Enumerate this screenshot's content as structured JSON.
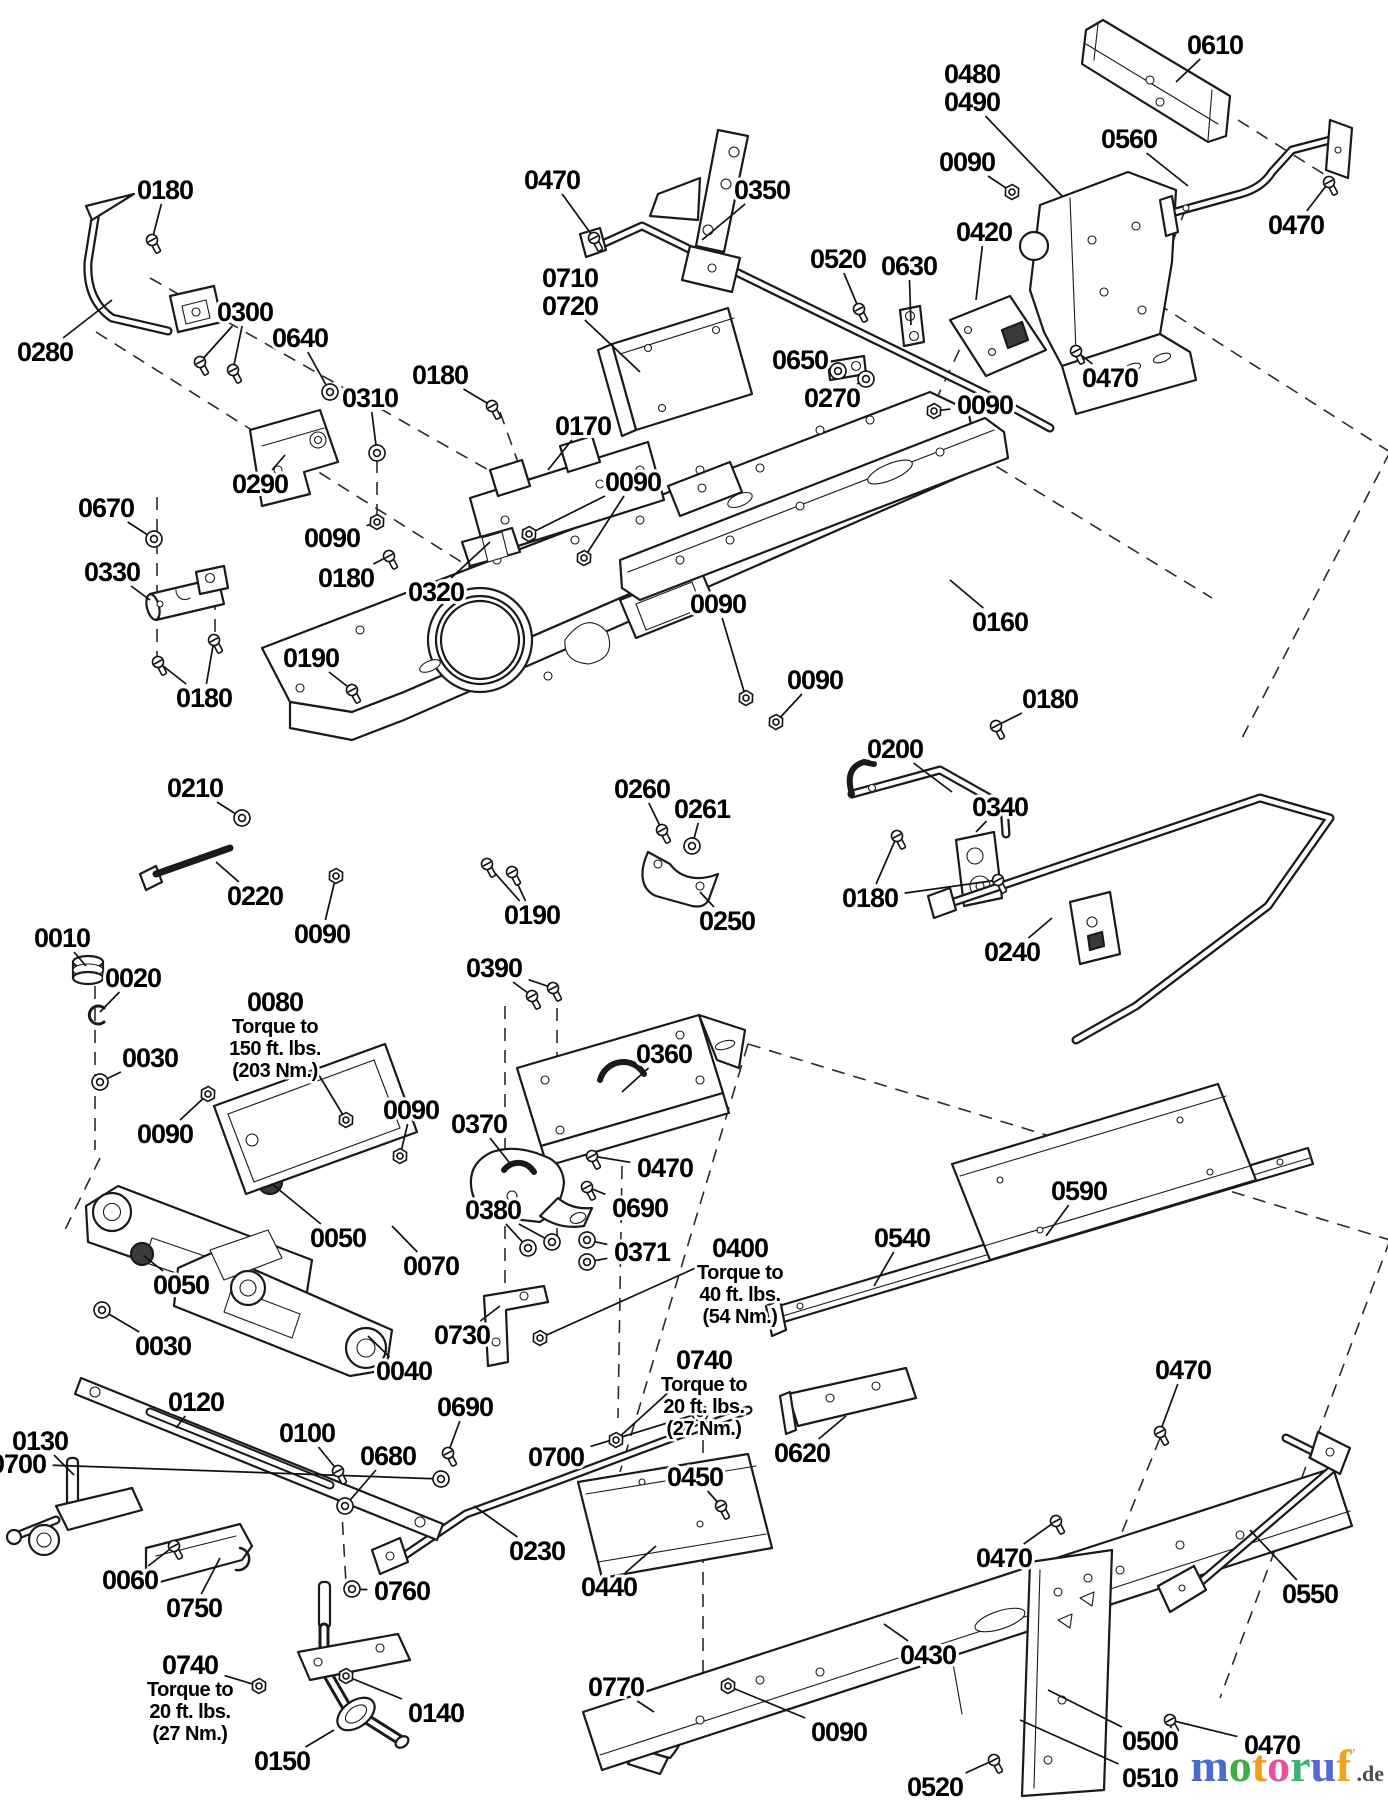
{
  "diagram": {
    "type": "exploded-parts-diagram",
    "torque_notes": [
      "Torque to 150 ft. lbs. (203 Nm.)",
      "Torque to 40 ft. lbs. (54 Nm.)",
      "Torque to 20 ft. lbs. (27 Nm.)",
      "Torque to 20 ft. lbs. (27 Nm.)"
    ],
    "callouts": [
      {
        "id": "0610",
        "x": 1215,
        "y": 45,
        "hw": null,
        "leaders": [
          [
            1176,
            82
          ]
        ]
      },
      {
        "id": "0480",
        "x": 972,
        "y": 74,
        "hw": null,
        "leaders": []
      },
      {
        "id": "0490",
        "x": 972,
        "y": 102,
        "hw": null,
        "leaders": [
          [
            1062,
            196
          ]
        ]
      },
      {
        "id": "0090",
        "x": 967,
        "y": 162,
        "hw": "nut",
        "leaders": [
          [
            1012,
            192
          ]
        ]
      },
      {
        "id": "0560",
        "x": 1129,
        "y": 139,
        "hw": null,
        "leaders": [
          [
            1188,
            186
          ]
        ]
      },
      {
        "id": "0470",
        "x": 1296,
        "y": 225,
        "hw": "bolt",
        "leaders": [
          [
            1329,
            182
          ]
        ]
      },
      {
        "id": "0470",
        "x": 552,
        "y": 180,
        "hw": "bolt",
        "leaders": [
          [
            594,
            238
          ]
        ]
      },
      {
        "id": "0350",
        "x": 762,
        "y": 190,
        "hw": null,
        "leaders": [
          [
            702,
            240
          ]
        ]
      },
      {
        "id": "0180",
        "x": 165,
        "y": 190,
        "hw": "bolt",
        "leaders": [
          [
            152,
            240
          ]
        ]
      },
      {
        "id": "0420",
        "x": 984,
        "y": 232,
        "hw": null,
        "leaders": [
          [
            976,
            300
          ]
        ]
      },
      {
        "id": "0520",
        "x": 838,
        "y": 259,
        "hw": "bolt",
        "leaders": [
          [
            859,
            309
          ]
        ]
      },
      {
        "id": "0630",
        "x": 909,
        "y": 266,
        "hw": null,
        "leaders": [
          [
            911,
            325
          ]
        ]
      },
      {
        "id": "0710",
        "x": 570,
        "y": 278,
        "hw": null,
        "leaders": []
      },
      {
        "id": "0720",
        "x": 570,
        "y": 306,
        "hw": null,
        "leaders": [
          [
            640,
            372
          ]
        ]
      },
      {
        "id": "0300",
        "x": 245,
        "y": 312,
        "hw": "bolt",
        "leaders": [
          [
            200,
            362
          ],
          [
            233,
            370
          ]
        ]
      },
      {
        "id": "0640",
        "x": 300,
        "y": 338,
        "hw": "washer",
        "leaders": [
          [
            330,
            392
          ]
        ]
      },
      {
        "id": "0280",
        "x": 45,
        "y": 352,
        "hw": null,
        "leaders": [
          [
            112,
            300
          ]
        ]
      },
      {
        "id": "0650",
        "x": 800,
        "y": 360,
        "hw": "washer",
        "leaders": [
          [
            838,
            371
          ]
        ]
      },
      {
        "id": "0270",
        "x": 832,
        "y": 398,
        "hw": "washer",
        "leaders": [
          [
            866,
            379
          ]
        ]
      },
      {
        "id": "0090",
        "x": 985,
        "y": 405,
        "hw": "nut",
        "leaders": [
          [
            934,
            411
          ]
        ]
      },
      {
        "id": "0470",
        "x": 1110,
        "y": 378,
        "hw": "bolt",
        "leaders": [
          [
            1076,
            351
          ]
        ]
      },
      {
        "id": "0310",
        "x": 370,
        "y": 398,
        "hw": "washer",
        "leaders": [
          [
            377,
            453
          ]
        ]
      },
      {
        "id": "0180",
        "x": 440,
        "y": 375,
        "hw": "bolt",
        "leaders": [
          [
            492,
            406
          ]
        ]
      },
      {
        "id": "0170",
        "x": 583,
        "y": 426,
        "hw": null,
        "leaders": [
          [
            548,
            470
          ]
        ]
      },
      {
        "id": "0290",
        "x": 260,
        "y": 484,
        "hw": null,
        "leaders": [
          [
            285,
            455
          ]
        ]
      },
      {
        "id": "0090",
        "x": 633,
        "y": 482,
        "hw": "nut",
        "leaders": [
          [
            529,
            534
          ],
          [
            584,
            558
          ]
        ]
      },
      {
        "id": "0670",
        "x": 106,
        "y": 508,
        "hw": "washer",
        "leaders": [
          [
            154,
            539
          ]
        ]
      },
      {
        "id": "0330",
        "x": 112,
        "y": 572,
        "hw": null,
        "leaders": [
          [
            150,
            600
          ]
        ]
      },
      {
        "id": "0090",
        "x": 332,
        "y": 538,
        "hw": "nut",
        "leaders": [
          [
            377,
            522
          ]
        ]
      },
      {
        "id": "0180",
        "x": 346,
        "y": 578,
        "hw": "bolt",
        "leaders": [
          [
            389,
            556
          ]
        ]
      },
      {
        "id": "0320",
        "x": 436,
        "y": 592,
        "hw": null,
        "leaders": [
          [
            490,
            542
          ]
        ]
      },
      {
        "id": "0180",
        "x": 204,
        "y": 698,
        "hw": "bolt",
        "leaders": [
          [
            158,
            662
          ],
          [
            214,
            640
          ]
        ]
      },
      {
        "id": "0190",
        "x": 311,
        "y": 658,
        "hw": "bolt",
        "leaders": [
          [
            352,
            690
          ]
        ]
      },
      {
        "id": "0090",
        "x": 718,
        "y": 604,
        "hw": "nut",
        "leaders": [
          [
            746,
            698
          ]
        ]
      },
      {
        "id": "0160",
        "x": 1000,
        "y": 622,
        "hw": null,
        "leaders": [
          [
            950,
            580
          ]
        ]
      },
      {
        "id": "0090",
        "x": 815,
        "y": 680,
        "hw": "nut",
        "leaders": [
          [
            776,
            722
          ]
        ]
      },
      {
        "id": "0180",
        "x": 1050,
        "y": 699,
        "hw": "bolt",
        "leaders": [
          [
            996,
            726
          ]
        ]
      },
      {
        "id": "0200",
        "x": 895,
        "y": 749,
        "hw": null,
        "leaders": [
          [
            952,
            792
          ]
        ]
      },
      {
        "id": "0340",
        "x": 1000,
        "y": 807,
        "hw": null,
        "leaders": [
          [
            976,
            832
          ]
        ]
      },
      {
        "id": "0180",
        "x": 870,
        "y": 898,
        "hw": "bolt",
        "leaders": [
          [
            897,
            836
          ],
          [
            998,
            880
          ]
        ]
      },
      {
        "id": "0240",
        "x": 1012,
        "y": 952,
        "hw": null,
        "leaders": [
          [
            1052,
            918
          ]
        ]
      },
      {
        "id": "0210",
        "x": 195,
        "y": 788,
        "hw": "washer",
        "leaders": [
          [
            242,
            818
          ]
        ]
      },
      {
        "id": "0220",
        "x": 255,
        "y": 896,
        "hw": null,
        "leaders": [
          [
            216,
            862
          ]
        ]
      },
      {
        "id": "0090",
        "x": 322,
        "y": 934,
        "hw": "nut",
        "leaders": [
          [
            336,
            876
          ]
        ]
      },
      {
        "id": "0190",
        "x": 532,
        "y": 915,
        "hw": "bolt",
        "leaders": [
          [
            487,
            864
          ],
          [
            512,
            872
          ]
        ]
      },
      {
        "id": "0260",
        "x": 642,
        "y": 789,
        "hw": "bolt",
        "leaders": [
          [
            662,
            830
          ]
        ]
      },
      {
        "id": "0261",
        "x": 702,
        "y": 809,
        "hw": "washer",
        "leaders": [
          [
            692,
            846
          ]
        ]
      },
      {
        "id": "0250",
        "x": 727,
        "y": 921,
        "hw": null,
        "leaders": [
          [
            700,
            892
          ]
        ]
      },
      {
        "id": "0010",
        "x": 62,
        "y": 938,
        "hw": null,
        "leaders": [
          [
            86,
            966
          ]
        ]
      },
      {
        "id": "0020",
        "x": 133,
        "y": 978,
        "hw": null,
        "leaders": [
          [
            100,
            1012
          ]
        ]
      },
      {
        "id": "0030",
        "x": 150,
        "y": 1058,
        "hw": "washer",
        "leaders": [
          [
            100,
            1082
          ]
        ]
      },
      {
        "id": "0090",
        "x": 165,
        "y": 1134,
        "hw": "nut",
        "leaders": [
          [
            208,
            1094
          ]
        ]
      },
      {
        "id": "0080",
        "x": 275,
        "y": 1002,
        "hw": "nut",
        "leaders": [
          [
            346,
            1120
          ]
        ],
        "note": [
          "Torque to",
          "150 ft. lbs.",
          "(203 Nm.)"
        ]
      },
      {
        "id": "0090",
        "x": 411,
        "y": 1110,
        "hw": "nut",
        "leaders": [
          [
            400,
            1156
          ]
        ]
      },
      {
        "id": "0390",
        "x": 494,
        "y": 968,
        "hw": "bolt",
        "leaders": [
          [
            532,
            996
          ],
          [
            553,
            988
          ]
        ]
      },
      {
        "id": "0360",
        "x": 664,
        "y": 1054,
        "hw": null,
        "leaders": [
          [
            622,
            1092
          ]
        ]
      },
      {
        "id": "0370",
        "x": 479,
        "y": 1124,
        "hw": null,
        "leaders": [
          [
            512,
            1166
          ]
        ]
      },
      {
        "id": "0470",
        "x": 665,
        "y": 1168,
        "hw": "bolt",
        "leaders": [
          [
            592,
            1156
          ]
        ]
      },
      {
        "id": "0690",
        "x": 640,
        "y": 1208,
        "hw": "bolt",
        "leaders": [
          [
            587,
            1187
          ]
        ]
      },
      {
        "id": "0380",
        "x": 493,
        "y": 1210,
        "hw": "washer",
        "leaders": [
          [
            528,
            1248
          ],
          [
            552,
            1242
          ]
        ]
      },
      {
        "id": "0371",
        "x": 642,
        "y": 1252,
        "hw": "washer",
        "leaders": [
          [
            587,
            1240
          ],
          [
            587,
            1262
          ]
        ]
      },
      {
        "id": "0400",
        "x": 740,
        "y": 1248,
        "hw": "nut",
        "leaders": [
          [
            540,
            1338
          ]
        ],
        "note": [
          "Torque to",
          "40 ft. lbs.",
          "(54 Nm.)"
        ]
      },
      {
        "id": "0050",
        "x": 338,
        "y": 1238,
        "hw": null,
        "leaders": [
          [
            272,
            1184
          ]
        ]
      },
      {
        "id": "0070",
        "x": 431,
        "y": 1266,
        "hw": null,
        "leaders": [
          [
            392,
            1226
          ]
        ]
      },
      {
        "id": "0050",
        "x": 181,
        "y": 1285,
        "hw": null,
        "leaders": [
          [
            144,
            1256
          ]
        ]
      },
      {
        "id": "0030",
        "x": 163,
        "y": 1346,
        "hw": "washer",
        "leaders": [
          [
            102,
            1310
          ]
        ]
      },
      {
        "id": "0040",
        "x": 404,
        "y": 1371,
        "hw": null,
        "leaders": [
          [
            368,
            1336
          ]
        ]
      },
      {
        "id": "0730",
        "x": 462,
        "y": 1335,
        "hw": null,
        "leaders": [
          [
            500,
            1306
          ]
        ]
      },
      {
        "id": "0540",
        "x": 902,
        "y": 1238,
        "hw": null,
        "leaders": [
          [
            874,
            1286
          ]
        ]
      },
      {
        "id": "0590",
        "x": 1079,
        "y": 1191,
        "hw": null,
        "leaders": [
          [
            1046,
            1236
          ]
        ]
      },
      {
        "id": "0740",
        "x": 704,
        "y": 1360,
        "hw": "nut",
        "leaders": [
          [
            616,
            1440
          ]
        ],
        "note": [
          "Torque to",
          "20 ft. lbs.",
          "(27 Nm.)"
        ]
      },
      {
        "id": "0470",
        "x": 1183,
        "y": 1370,
        "hw": "bolt",
        "leaders": [
          [
            1160,
            1432
          ]
        ]
      },
      {
        "id": "0120",
        "x": 196,
        "y": 1402,
        "hw": null,
        "leaders": [
          [
            176,
            1428
          ]
        ]
      },
      {
        "id": "0130",
        "x": 40,
        "y": 1441,
        "hw": null,
        "leaders": [
          [
            74,
            1475
          ]
        ]
      },
      {
        "id": "0100",
        "x": 307,
        "y": 1433,
        "hw": "bolt",
        "leaders": [
          [
            338,
            1471
          ]
        ]
      },
      {
        "id": "0680",
        "x": 388,
        "y": 1456,
        "hw": "washer",
        "leaders": [
          [
            345,
            1506
          ]
        ]
      },
      {
        "id": "0690",
        "x": 465,
        "y": 1407,
        "hw": "bolt",
        "leaders": [
          [
            448,
            1453
          ]
        ]
      },
      {
        "id": "0700",
        "x": 18,
        "y": 1464,
        "hw": "washer",
        "leaders": [
          [
            441,
            1479
          ]
        ]
      },
      {
        "id": "0700",
        "x": 556,
        "y": 1457,
        "hw": "washer",
        "leaders": [
          [
            700,
            1413
          ]
        ]
      },
      {
        "id": "0230",
        "x": 537,
        "y": 1551,
        "hw": null,
        "leaders": [
          [
            474,
            1506
          ]
        ]
      },
      {
        "id": "0450",
        "x": 695,
        "y": 1477,
        "hw": "bolt",
        "leaders": [
          [
            721,
            1506
          ]
        ]
      },
      {
        "id": "0440",
        "x": 609,
        "y": 1587,
        "hw": null,
        "leaders": [
          [
            656,
            1546
          ]
        ]
      },
      {
        "id": "0060",
        "x": 130,
        "y": 1580,
        "hw": "bolt",
        "leaders": [
          [
            174,
            1546
          ]
        ]
      },
      {
        "id": "0750",
        "x": 194,
        "y": 1608,
        "hw": null,
        "leaders": [
          [
            220,
            1558
          ]
        ]
      },
      {
        "id": "0760",
        "x": 402,
        "y": 1591,
        "hw": "washer",
        "leaders": [
          [
            352,
            1589
          ]
        ]
      },
      {
        "id": "0740",
        "x": 190,
        "y": 1665,
        "hw": "nut",
        "leaders": [
          [
            259,
            1686
          ]
        ],
        "note": [
          "Torque to",
          "20 ft. lbs.",
          "(27 Nm.)"
        ]
      },
      {
        "id": "0140",
        "x": 436,
        "y": 1713,
        "hw": "nut",
        "leaders": [
          [
            346,
            1676
          ]
        ]
      },
      {
        "id": "0150",
        "x": 282,
        "y": 1761,
        "hw": null,
        "leaders": [
          [
            334,
            1730
          ]
        ]
      },
      {
        "id": "0770",
        "x": 616,
        "y": 1687,
        "hw": null,
        "leaders": [
          [
            654,
            1712
          ]
        ]
      },
      {
        "id": "0090",
        "x": 839,
        "y": 1732,
        "hw": "nut",
        "leaders": [
          [
            728,
            1686
          ]
        ]
      },
      {
        "id": "0620",
        "x": 802,
        "y": 1453,
        "hw": null,
        "leaders": [
          [
            846,
            1416
          ]
        ]
      },
      {
        "id": "0430",
        "x": 928,
        "y": 1655,
        "hw": null,
        "leaders": [
          [
            884,
            1624
          ]
        ]
      },
      {
        "id": "0470",
        "x": 1004,
        "y": 1558,
        "hw": "bolt",
        "leaders": [
          [
            1056,
            1521
          ]
        ]
      },
      {
        "id": "0550",
        "x": 1310,
        "y": 1594,
        "hw": null,
        "leaders": [
          [
            1250,
            1530
          ]
        ]
      },
      {
        "id": "0470",
        "x": 1272,
        "y": 1745,
        "hw": "bolt",
        "leaders": [
          [
            1170,
            1720
          ]
        ]
      },
      {
        "id": "0500",
        "x": 1150,
        "y": 1741,
        "hw": null,
        "leaders": [
          [
            1048,
            1690
          ]
        ]
      },
      {
        "id": "0510",
        "x": 1150,
        "y": 1778,
        "hw": null,
        "leaders": [
          [
            1020,
            1720
          ]
        ]
      },
      {
        "id": "0520",
        "x": 935,
        "y": 1787,
        "hw": "bolt",
        "leaders": [
          [
            994,
            1760
          ]
        ]
      }
    ]
  },
  "logo": {
    "letters": [
      {
        "ch": "m",
        "color": "#4a6bc9"
      },
      {
        "ch": "o",
        "color": "#3fae49"
      },
      {
        "ch": "t",
        "color": "#f59b18"
      },
      {
        "ch": "o",
        "color": "#ed4fa0"
      },
      {
        "ch": "r",
        "color": "#3cb371"
      },
      {
        "ch": "u",
        "color": "#5568d4"
      },
      {
        "ch": "f",
        "color": "#f6a21c"
      }
    ],
    "mark": "′",
    "mark_color": "#b9b9c0",
    "suffix": ".de",
    "suffix_color": "#4a4a55"
  }
}
